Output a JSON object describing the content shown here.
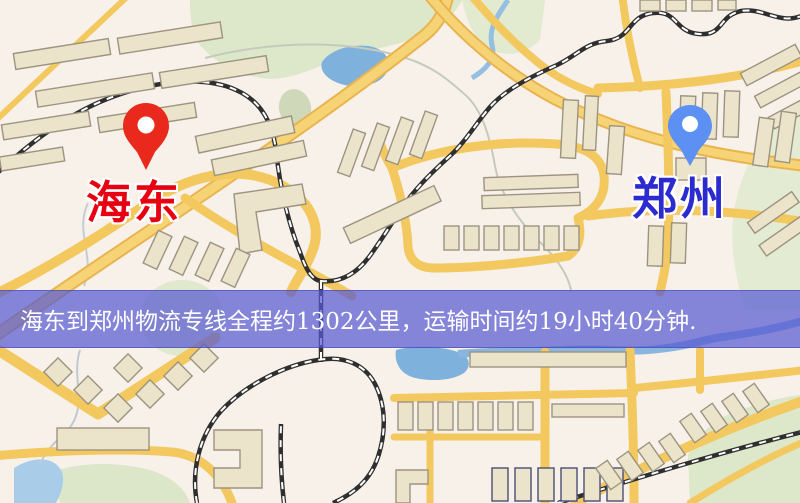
{
  "markers": {
    "origin": {
      "label": "海东",
      "label_color": "#e60012",
      "pin_color": "#e8291c"
    },
    "destination": {
      "label": "郑州",
      "label_color": "#2b2bd0",
      "pin_color": "#5c90f2"
    }
  },
  "banner": {
    "text": "海东到郑州物流专线全程约1302公里，运输时间约19小时40分钟.",
    "background": "#5a5cd2",
    "text_color": "#ffffff"
  },
  "map_colors": {
    "background": "#f7f1ea",
    "road": "#f3c85f",
    "road_major": "#f6d475",
    "park": "#dde7c9",
    "water": "#7fb1dd",
    "railway": "#2f2f2f",
    "building": "#ebe4cb"
  }
}
